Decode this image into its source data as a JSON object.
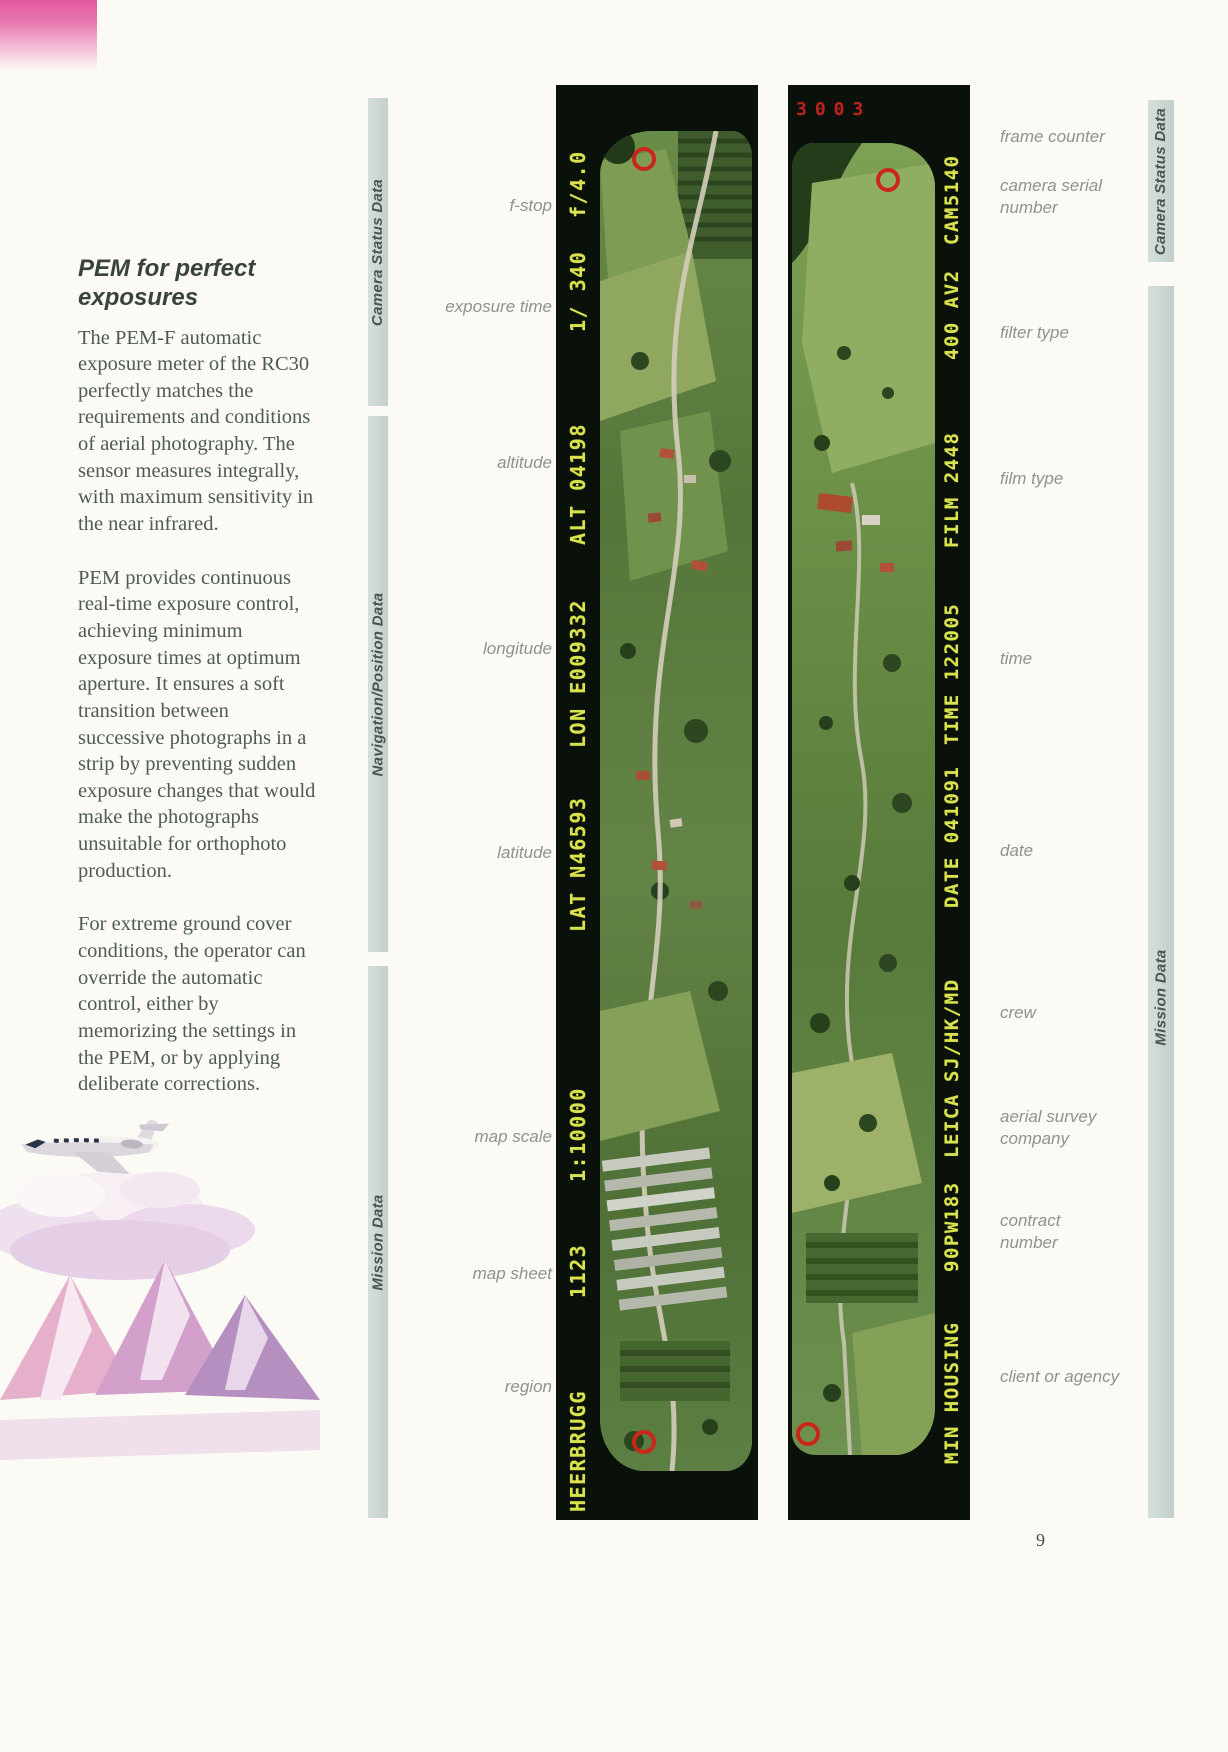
{
  "page": {
    "number": "9"
  },
  "article": {
    "heading_line1": "PEM for perfect",
    "heading_line2": "exposures",
    "paragraphs": [
      "The PEM-F automatic exposure meter of the RC30 perfectly matches the requirements and conditions of aerial photography. The sensor measures integrally, with maximum sensitivity in the near infrared.",
      "PEM provides continuous real-time exposure control, achieving minimum exposure times at optimum aperture. It ensures a soft transition between successive photographs in a strip by preventing sudden exposure changes that would make the photographs unsuitable for orthophoto production.",
      "For extreme ground cover conditions, the operator can override the automatic control, either by memorizing the settings in the PEM, or by applying deliberate corrections."
    ]
  },
  "left_panel": {
    "bars": [
      "Camera Status Data",
      "Navigation/Position Data",
      "Mission Data"
    ],
    "labels": [
      "f-stop",
      "exposure time",
      "altitude",
      "longitude",
      "latitude",
      "map scale",
      "map sheet",
      "region"
    ]
  },
  "right_panel": {
    "bars": [
      "Camera Status Data",
      "Mission Data"
    ],
    "labels": [
      "frame counter",
      "camera serial number",
      "filter type",
      "film type",
      "time",
      "date",
      "crew",
      "aerial survey company",
      "contract number",
      "client or agency"
    ]
  },
  "left_strip": {
    "annotations": {
      "fstop": "f/4.0",
      "exposure_time": "1/ 340",
      "altitude": "ALT 04198",
      "longitude": "LON E009332",
      "latitude": "LAT N46593",
      "map_scale": "1:10000",
      "map_sheet": "1123",
      "region": "HEERBRUGG"
    }
  },
  "right_strip": {
    "frame_counter": "3003",
    "annotations": {
      "camera_serial": "CAM5140",
      "filter_type": "400 AV2",
      "film_type": "FILM 2448",
      "time": "TIME 122005",
      "date": "DATE 041091",
      "crew": "SJ/HK/MD",
      "company": "LEICA",
      "contract": "90PW183",
      "client": "MIN HOUSING"
    }
  },
  "colors": {
    "annotation_yellow": "#d9e24f",
    "fiducial_red": "#ca261b",
    "bar_background": "#c9d4d0"
  }
}
